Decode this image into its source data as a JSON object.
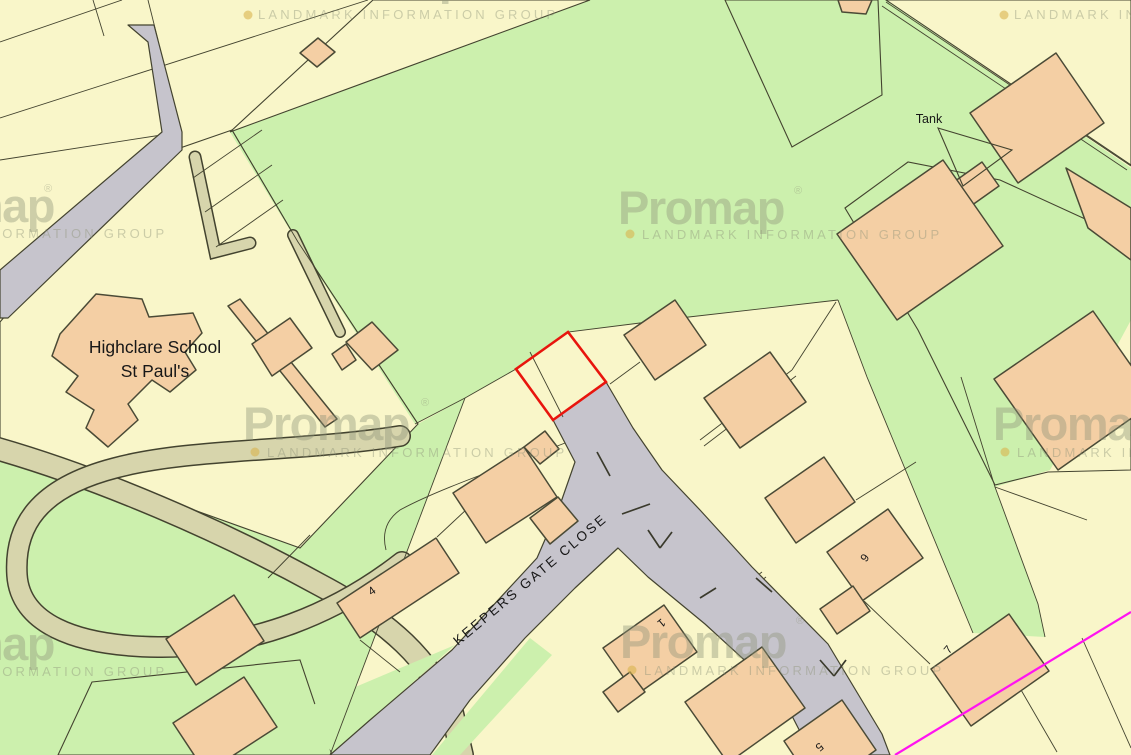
{
  "map": {
    "labels": {
      "school_line1": "Highclare School",
      "school_line2": "St Paul's",
      "tank": "Tank",
      "street": "KEEPERS GATE CLOSE"
    },
    "house_numbers": [
      "4",
      "9",
      "7",
      "1",
      "5"
    ],
    "watermark": {
      "logo": "Promap",
      "registered": "®",
      "trademark": "™",
      "tagline": "LANDMARK INFORMATION GROUP"
    },
    "colors": {
      "parcel": "#f9f6c9",
      "green": "#ccf0ad",
      "olive": "#d2d0a0",
      "olive2": "#d7d5ac",
      "yard": "#f6d4ae",
      "building": "#f4cfa4",
      "road": "#c6c4cc",
      "outline": "#43432f",
      "building_outline": "#4a4a36",
      "site": "#e8150d",
      "boundary": "#ff14f0",
      "label": "#171717",
      "watermark": "#8e9379",
      "watermark_dot": "#d8b44e"
    }
  }
}
